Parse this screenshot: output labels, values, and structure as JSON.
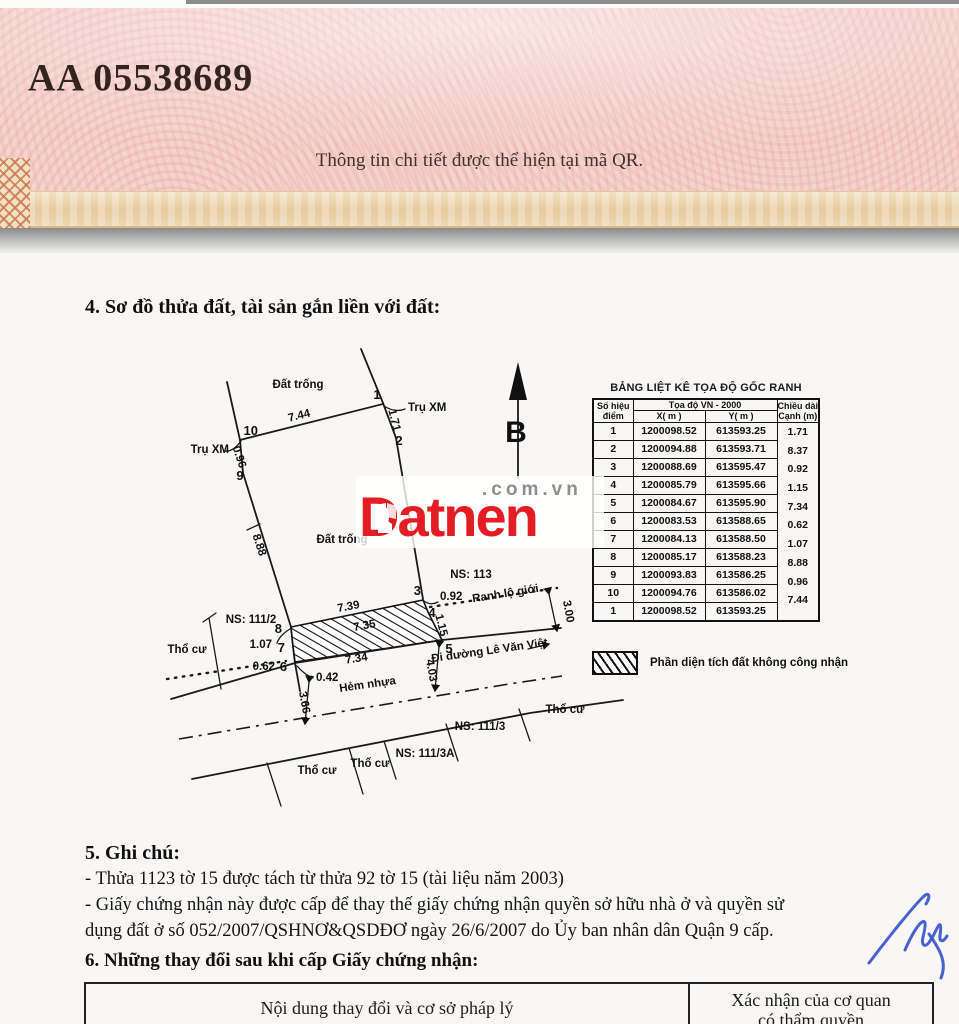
{
  "certificate": {
    "serial": "AA 05538689",
    "qr_note": "Thông tin chi tiết được thể hiện tại mã QR."
  },
  "section4": {
    "title": "4. Sơ đồ thửa đất, tài sản gắn liền với đất:"
  },
  "map": {
    "north_label": "B",
    "labels": {
      "dat_trong_top": "Đất trống",
      "dat_trong_mid": "Đất trống",
      "tru_xm_left": "Trụ XM",
      "tru_xm_right": "Trụ XM",
      "ns_111_2": "NS: 111/2",
      "ns_113": "NS: 113",
      "ns_111_3": "NS: 111/3",
      "ns_111_3a": "NS: 111/3A",
      "tho_cu_left": "Thổ cư",
      "tho_cu_bottom1": "Thổ cư",
      "tho_cu_bottom2": "Thổ cư",
      "tho_cu_right": "Thổ cư",
      "ranh_lo_gioi": "Ranh lộ giới",
      "hem_nhua": "Hẻm nhựa",
      "di_duong": "Đi đường Lê Văn Việt"
    },
    "points": {
      "p1": "1",
      "p2": "2",
      "p3": "3",
      "p4": "4",
      "p5": "5",
      "p6": "6",
      "p7": "7",
      "p8": "8",
      "p9": "9",
      "p10": "10"
    },
    "dims": {
      "d10_1": "7.44",
      "d1_2": "1.71",
      "d9_10": "0.96",
      "d8_9": "8.88",
      "d7_8": "1.07",
      "d6_7": "0.62",
      "d5_6": "7.34",
      "d4_5": "1.15",
      "d3_4": "0.92",
      "hatch_top": "7.39",
      "hatch_mid": "7.35",
      "w_042": "0.42",
      "w_300": "3.00",
      "w_403": "4.03",
      "w_366": "3.66"
    }
  },
  "coord_table": {
    "title": "BẢNG LIỆT KÊ TỌA ĐỘ GỐC RANH",
    "header": {
      "point": "Số hiệu điểm",
      "group": "Tọa độ VN - 2000",
      "x": "X( m )",
      "y": "Y( m )",
      "len": "Chiều dài Cạnh (m)"
    },
    "rows": [
      {
        "p": "1",
        "x": "1200098.52",
        "y": "613593.25"
      },
      {
        "p": "2",
        "x": "1200094.88",
        "y": "613593.71"
      },
      {
        "p": "3",
        "x": "1200088.69",
        "y": "613595.47"
      },
      {
        "p": "4",
        "x": "1200085.79",
        "y": "613595.66"
      },
      {
        "p": "5",
        "x": "1200084.67",
        "y": "613595.90"
      },
      {
        "p": "6",
        "x": "1200083.53",
        "y": "613588.65"
      },
      {
        "p": "7",
        "x": "1200084.13",
        "y": "613588.50"
      },
      {
        "p": "8",
        "x": "1200085.17",
        "y": "613588.23"
      },
      {
        "p": "9",
        "x": "1200093.83",
        "y": "613586.25"
      },
      {
        "p": "10",
        "x": "1200094.76",
        "y": "613586.02"
      },
      {
        "p": "1",
        "x": "1200098.52",
        "y": "613593.25"
      }
    ],
    "lengths": [
      "1.71",
      "8.37",
      "0.92",
      "1.15",
      "7.34",
      "0.62",
      "1.07",
      "8.88",
      "0.96",
      "7.44"
    ]
  },
  "legend": {
    "not_recognized": "Phần diện tích đất không công nhận"
  },
  "watermark": {
    "brand": "Datnen",
    "suffix": ".com.vn"
  },
  "section5": {
    "title": "5. Ghi chú:",
    "lines": [
      "- Thửa 1123 tờ 15 được tách từ thửa 92 tờ 15 (tài liệu năm 2003)",
      "- Giấy chứng nhận này được cấp để thay thế giấy chứng nhận quyền sở hữu nhà ở và quyền sử",
      "dụng đất ở số 052/2007/QSHNƠ&QSDĐƠ ngày 26/6/2007 do Ủy ban nhân dân Quận 9 cấp."
    ]
  },
  "section6": {
    "title": "6. Những thay đổi sau khi cấp Giấy chứng nhận:",
    "col_left": "Nội dung thay đổi và cơ sở pháp lý",
    "col_right_line1": "Xác nhận của cơ quan",
    "col_right_line2": "có thẩm quyền"
  }
}
